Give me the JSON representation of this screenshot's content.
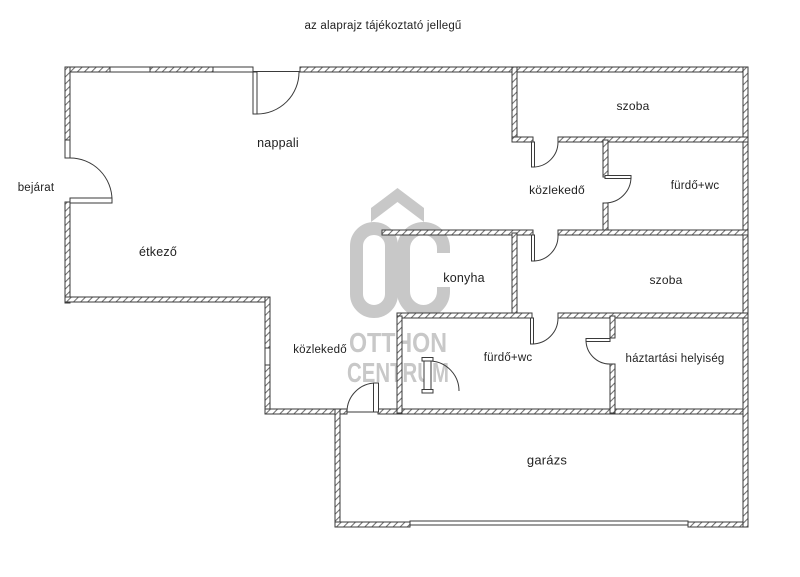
{
  "title": "az alaprajz tájékoztató jellegű",
  "rooms": {
    "bejarat": {
      "label": "bejárat"
    },
    "nappali": {
      "label": "nappali"
    },
    "etkezo": {
      "label": "étkező"
    },
    "szoba_top": {
      "label": "szoba"
    },
    "kozlekedo_top": {
      "label": "közlekedő"
    },
    "furdo_wc_top": {
      "label": "fürdő+wc"
    },
    "konyha": {
      "label": "konyha"
    },
    "szoba_middle": {
      "label": "szoba"
    },
    "kozlekedo_bottom": {
      "label": "közlekedő"
    },
    "furdo_wc_bottom": {
      "label": "fürdő+wc"
    },
    "haztartasi": {
      "label": "háztartási helyiség"
    },
    "garazs": {
      "label": "garázs"
    }
  },
  "watermark": {
    "line1": "OTTHON",
    "line2": "CENTRUM",
    "color": "#c8c8c8"
  },
  "colors": {
    "wall_outline": "#3a3a3a",
    "wall_hatch": "#707070",
    "text": "#222222",
    "background": "#ffffff"
  }
}
